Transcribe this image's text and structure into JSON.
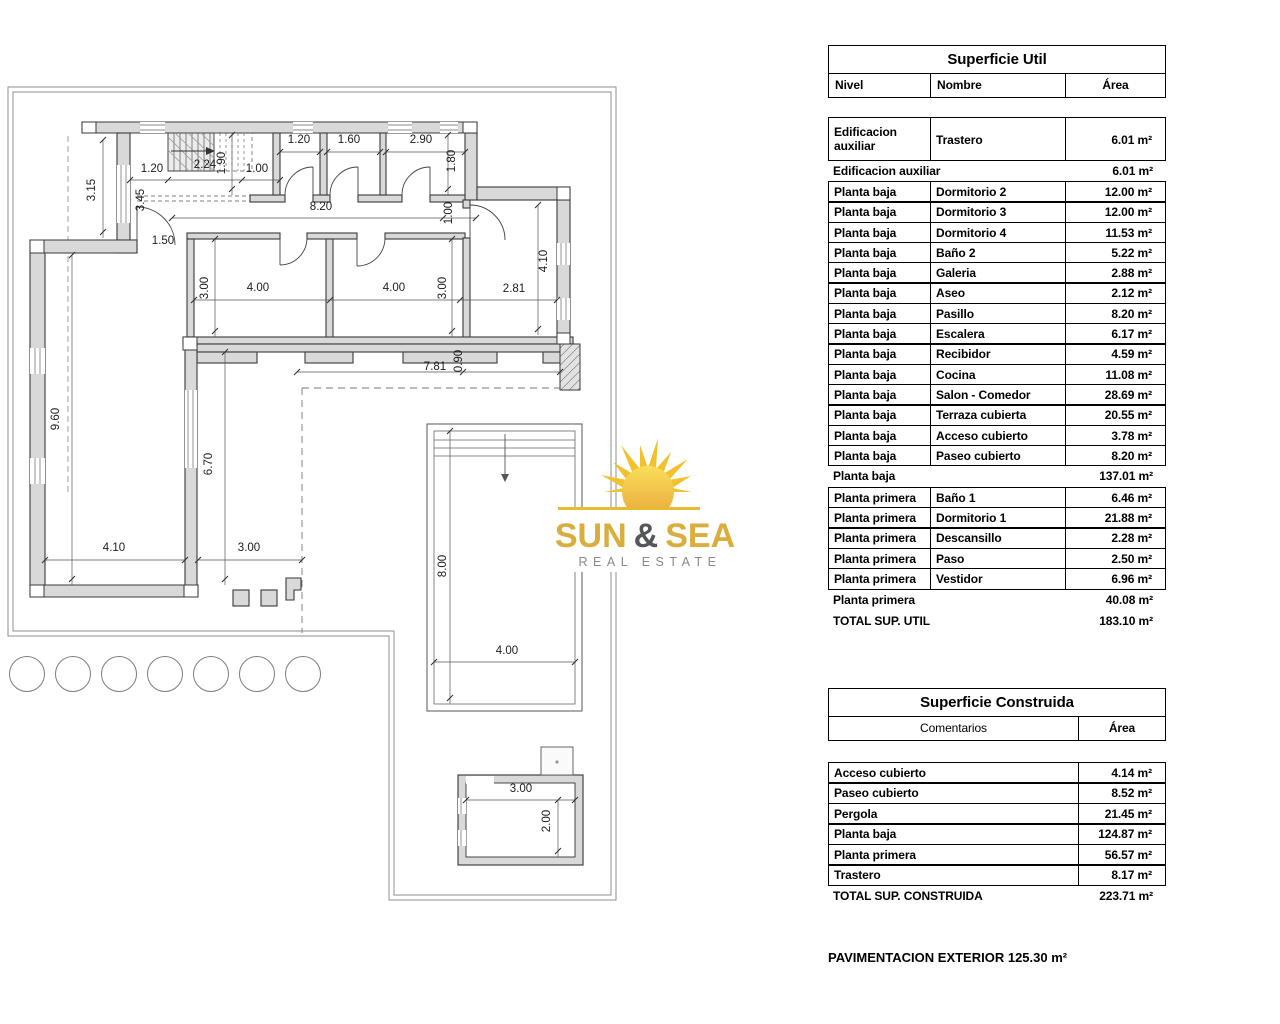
{
  "tables": {
    "superficie_util": {
      "title": "Superficie Util",
      "col_headers": [
        "Nivel",
        "Nombre",
        "Área"
      ],
      "rows": [
        {
          "type": "data",
          "tall": true,
          "nivel": "Edificacion auxiliar",
          "nombre": "Trastero",
          "area": "6.01 m²"
        },
        {
          "type": "subtotal",
          "label": "Edificacion auxiliar",
          "area": "6.01 m²"
        },
        {
          "type": "data",
          "nivel": "Planta baja",
          "nombre": "Dormitorio 2",
          "area": "12.00 m²"
        },
        {
          "type": "data",
          "nivel": "Planta baja",
          "nombre": "Dormitorio 3",
          "area": "12.00 m²"
        },
        {
          "type": "data",
          "nivel": "Planta baja",
          "nombre": "Dormitorio 4",
          "area": "11.53 m²"
        },
        {
          "type": "data",
          "nivel": "Planta baja",
          "nombre": "Baño 2",
          "area": "5.22 m²"
        },
        {
          "type": "data",
          "nivel": "Planta baja",
          "nombre": "Galeria",
          "area": "2.88 m²"
        },
        {
          "type": "data",
          "nivel": "Planta baja",
          "nombre": "Aseo",
          "area": "2.12 m²"
        },
        {
          "type": "data",
          "nivel": "Planta baja",
          "nombre": "Pasillo",
          "area": "8.20 m²"
        },
        {
          "type": "data",
          "nivel": "Planta baja",
          "nombre": "Escalera",
          "area": "6.17 m²"
        },
        {
          "type": "data",
          "nivel": "Planta baja",
          "nombre": "Recibidor",
          "area": "4.59 m²"
        },
        {
          "type": "data",
          "nivel": "Planta baja",
          "nombre": "Cocina",
          "area": "11.08 m²"
        },
        {
          "type": "data",
          "nivel": "Planta baja",
          "nombre": "Salon - Comedor",
          "area": "28.69 m²"
        },
        {
          "type": "data",
          "nivel": "Planta baja",
          "nombre": "Terraza cubierta",
          "area": "20.55 m²"
        },
        {
          "type": "data",
          "nivel": "Planta baja",
          "nombre": "Acceso cubierto",
          "area": "3.78 m²"
        },
        {
          "type": "data",
          "nivel": "Planta baja",
          "nombre": "Paseo cubierto",
          "area": "8.20 m²"
        },
        {
          "type": "subtotal",
          "label": "Planta baja",
          "area": "137.01 m²"
        },
        {
          "type": "data",
          "nivel": "Planta primera",
          "nombre": "Baño 1",
          "area": "6.46 m²"
        },
        {
          "type": "data",
          "nivel": "Planta primera",
          "nombre": "Dormitorio 1",
          "area": "21.88 m²"
        },
        {
          "type": "data",
          "nivel": "Planta primera",
          "nombre": "Descansillo",
          "area": "2.28 m²"
        },
        {
          "type": "data",
          "nivel": "Planta primera",
          "nombre": "Paso",
          "area": "2.50 m²"
        },
        {
          "type": "data",
          "nivel": "Planta primera",
          "nombre": "Vestidor",
          "area": "6.96 m²"
        },
        {
          "type": "subtotal",
          "label": "Planta primera",
          "area": "40.08 m²"
        },
        {
          "type": "total",
          "label": "TOTAL SUP. UTIL",
          "area": "183.10 m²"
        }
      ]
    },
    "superficie_construida": {
      "title": "Superficie Construida",
      "col_headers": [
        "Comentarios",
        "Área"
      ],
      "rows": [
        {
          "type": "data",
          "nombre": "Acceso cubierto",
          "area": "4.14 m²"
        },
        {
          "type": "data",
          "nombre": "Paseo cubierto",
          "area": "8.52 m²"
        },
        {
          "type": "data",
          "nombre": "Pergola",
          "area": "21.45 m²"
        },
        {
          "type": "data",
          "nombre": "Planta baja",
          "area": "124.87 m²"
        },
        {
          "type": "data",
          "nombre": "Planta primera",
          "area": "56.57 m²"
        },
        {
          "type": "data",
          "nombre": "Trastero",
          "area": "8.17 m²"
        },
        {
          "type": "total",
          "label": "TOTAL SUP. CONSTRUIDA",
          "area": "223.71 m²"
        }
      ]
    },
    "footnote": "PAVIMENTACION EXTERIOR 125.30 m²"
  },
  "logo": {
    "text_sun": "SUN",
    "text_amp": "&",
    "text_sea": "SEA",
    "tagline": "REAL ESTATE",
    "gold": "#D9AE3C",
    "sun_fill": "#F2C12E",
    "amp_color": "#55565A",
    "tagline_color": "#87898C"
  },
  "plan": {
    "dim_labels": [
      {
        "t": "3.15",
        "x": 95,
        "y": 190,
        "r": -90
      },
      {
        "t": "3.45",
        "x": 144,
        "y": 200,
        "r": -90
      },
      {
        "t": "1.20",
        "x": 152,
        "y": 172,
        "r": 0
      },
      {
        "t": "2.24",
        "x": 205,
        "y": 168,
        "r": 0
      },
      {
        "t": "1.90",
        "x": 225,
        "y": 163,
        "r": -90
      },
      {
        "t": "1.00",
        "x": 257,
        "y": 172,
        "r": 0
      },
      {
        "t": "1.20",
        "x": 299,
        "y": 143,
        "r": 0
      },
      {
        "t": "1.60",
        "x": 349,
        "y": 143,
        "r": 0
      },
      {
        "t": "2.90",
        "x": 421,
        "y": 143,
        "r": 0
      },
      {
        "t": "1.80",
        "x": 455,
        "y": 161,
        "r": -90
      },
      {
        "t": "8.20",
        "x": 321,
        "y": 210,
        "r": 0
      },
      {
        "t": "1.00",
        "x": 452,
        "y": 213,
        "r": -90
      },
      {
        "t": "1.50",
        "x": 163,
        "y": 244,
        "r": 0
      },
      {
        "t": "3.00",
        "x": 208,
        "y": 288,
        "r": -90
      },
      {
        "t": "4.00",
        "x": 258,
        "y": 291,
        "r": 0
      },
      {
        "t": "4.00",
        "x": 394,
        "y": 291,
        "r": 0
      },
      {
        "t": "3.00",
        "x": 446,
        "y": 288,
        "r": -90
      },
      {
        "t": "2.81",
        "x": 514,
        "y": 292,
        "r": 0
      },
      {
        "t": "4.10",
        "x": 547,
        "y": 261,
        "r": -90
      },
      {
        "t": "7.81",
        "x": 435,
        "y": 370,
        "r": 0
      },
      {
        "t": "0.90",
        "x": 462,
        "y": 361,
        "r": -90
      },
      {
        "t": "9.60",
        "x": 59,
        "y": 419,
        "r": -90
      },
      {
        "t": "6.70",
        "x": 212,
        "y": 464,
        "r": -90
      },
      {
        "t": "4.10",
        "x": 114,
        "y": 551,
        "r": 0
      },
      {
        "t": "3.00",
        "x": 249,
        "y": 551,
        "r": 0
      },
      {
        "t": "8.00",
        "x": 446,
        "y": 566,
        "r": -90
      },
      {
        "t": "4.00",
        "x": 507,
        "y": 654,
        "r": 0
      },
      {
        "t": "3.00",
        "x": 521,
        "y": 792,
        "r": 0
      },
      {
        "t": "2.00",
        "x": 550,
        "y": 821,
        "r": -90
      }
    ]
  }
}
